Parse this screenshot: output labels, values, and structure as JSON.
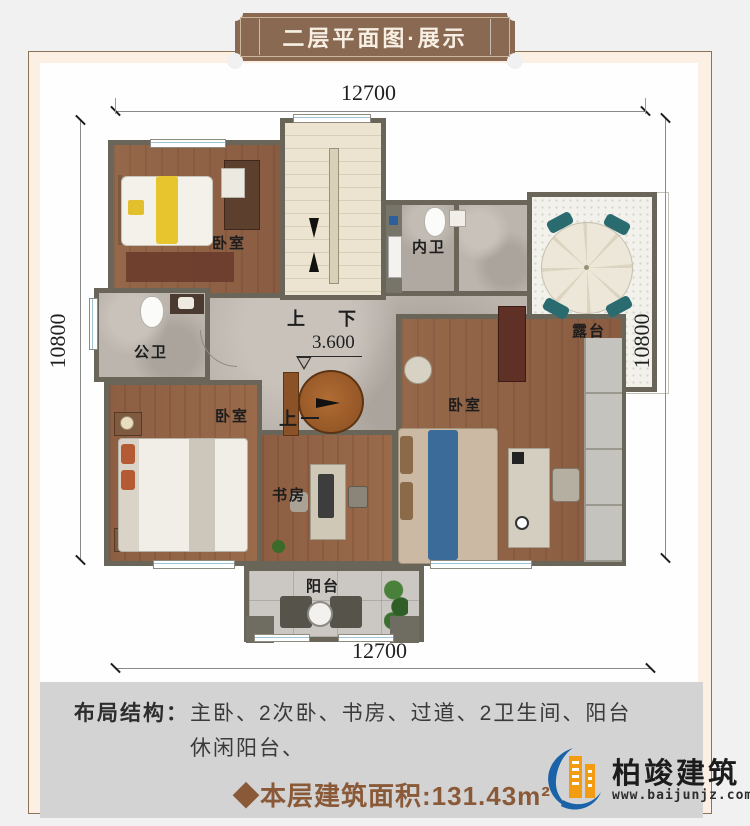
{
  "header": {
    "badge": "二层平面图·展示"
  },
  "dimensions": {
    "top": "12700",
    "bottom": "12700",
    "left": "10800",
    "right": "10800"
  },
  "plan": {
    "labels": {
      "bedroom_tl": "卧室",
      "bedroom_bl": "卧室",
      "bedroom_r": "卧室",
      "inner_bath": "内卫",
      "public_bath": "公卫",
      "terrace": "露台",
      "study": "书房",
      "balcony": "阳台",
      "stair_up": "上",
      "stair_down": "下",
      "stair_up2": "上",
      "elevation": "3.600"
    }
  },
  "footer": {
    "layout_label": "布局结构：",
    "layout_line1": "主卧、2次卧、书房、过道、2卫生间、阳台",
    "layout_line2": "休闲阳台、",
    "area": "◆本层建筑面积:131.43m²"
  },
  "logo": {
    "name": "柏竣建筑",
    "url": "www.baijunjz.com"
  },
  "colors": {
    "badge_brown": "#8a6952",
    "area_text": "#8a5a38",
    "wall": "#696659",
    "footer_bg": "#d3d3d3",
    "logo_blue": "#1a63a8",
    "logo_orange": "#f39c12",
    "window_blue": "#9fc4d8"
  }
}
